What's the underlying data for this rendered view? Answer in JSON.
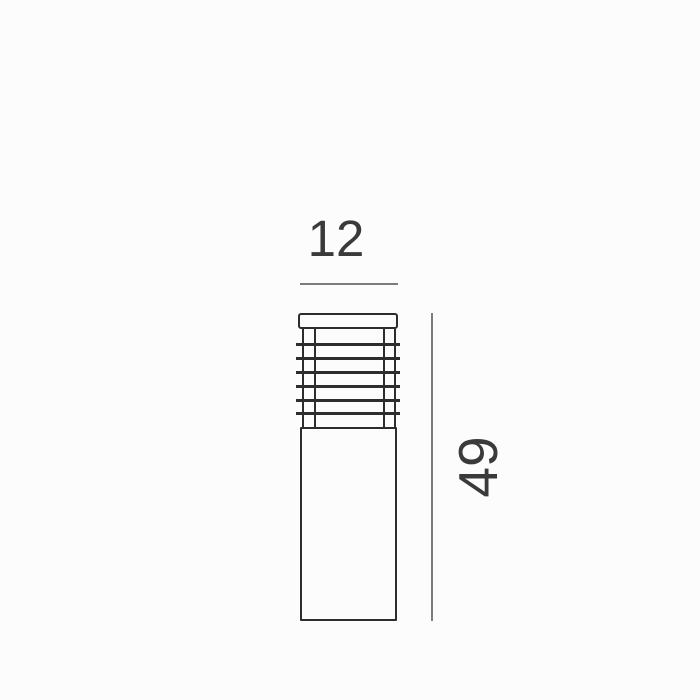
{
  "diagram": {
    "type": "technical-dimension-drawing",
    "subject": "bollard-light-front-elevation",
    "width_dim": {
      "value": "12"
    },
    "height_dim": {
      "value": "49"
    },
    "louver": {
      "slat_count": 6,
      "post_count": 4
    }
  },
  "colors": {
    "bg": "#fcfcfc",
    "outline": "#2d2d2d",
    "dimline": "#7c7c7c",
    "labeltext": "#3a3a3a"
  }
}
